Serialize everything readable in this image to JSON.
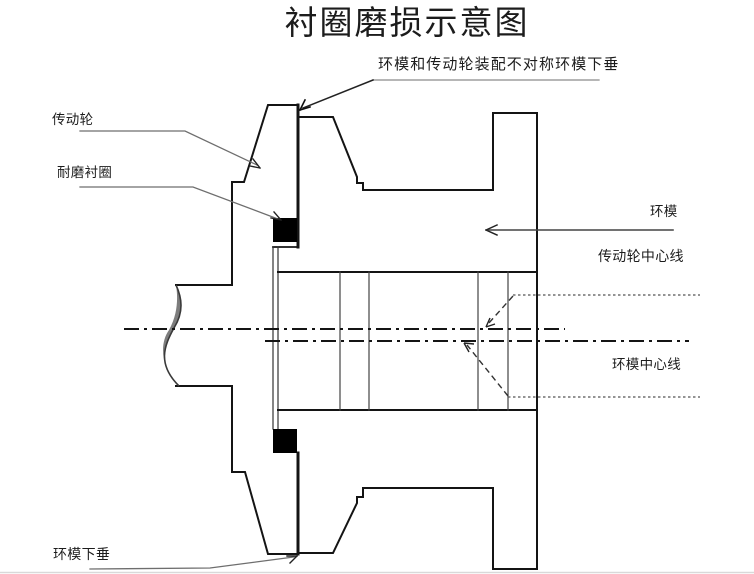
{
  "title": "衬圈磨损示意图",
  "annotations": {
    "top_note": "环模和传动轮装配不对称环模下垂",
    "drive_wheel": "传动轮",
    "wear_liner": "耐磨衬圈",
    "ring_die": "环模",
    "drive_wheel_centerline": "传动轮中心线",
    "ring_die_centerline": "环模中心线",
    "ring_die_sag": "环模下垂"
  },
  "colors": {
    "background": "#ffffff",
    "outline": "#141414",
    "thin_line": "#444444",
    "leader_line": "#6e6e6e",
    "liner_fill": "#000000",
    "break_shading": "#7d7d7d",
    "page_edge": "#d9d9d9"
  }
}
